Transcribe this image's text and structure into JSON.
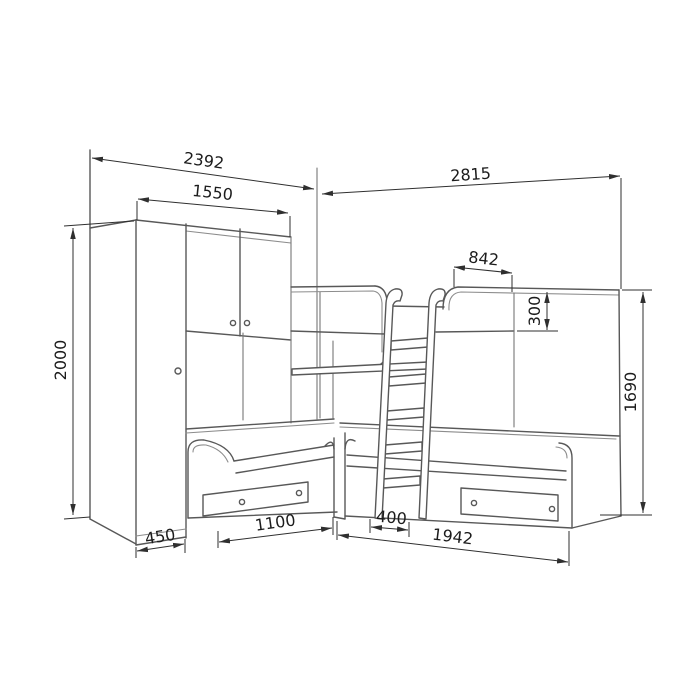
{
  "drawing": {
    "kind": "furniture dimension drawing",
    "subject": "corner bunk-bed set with wardrobe, two lower beds, upper bunk and ladder",
    "background": "#ffffff",
    "line_color": "#585858",
    "thin_line_color": "#8c8c8c",
    "dimension_line_color": "#2f2f2f",
    "text_color": "#1c1c1c",
    "dimensions": [
      {
        "name": "total-width-left-wall",
        "value": "2392",
        "orientation": "horizontal"
      },
      {
        "name": "wardrobe-front-width",
        "value": "1550",
        "orientation": "horizontal"
      },
      {
        "name": "total-width-right-wall",
        "value": "2815",
        "orientation": "horizontal"
      },
      {
        "name": "upper-bunk-headguard-length",
        "value": "842",
        "orientation": "horizontal"
      },
      {
        "name": "upper-guard-rail-height",
        "value": "300",
        "orientation": "vertical"
      },
      {
        "name": "wardrobe-height",
        "value": "2000",
        "orientation": "vertical"
      },
      {
        "name": "overall-height-right",
        "value": "1690",
        "orientation": "vertical"
      },
      {
        "name": "wardrobe-depth",
        "value": "450",
        "orientation": "horizontal"
      },
      {
        "name": "left-bed-front-length",
        "value": "1100",
        "orientation": "horizontal"
      },
      {
        "name": "ladder-width",
        "value": "400",
        "orientation": "horizontal"
      },
      {
        "name": "right-bed-length",
        "value": "1942",
        "orientation": "horizontal"
      }
    ]
  }
}
